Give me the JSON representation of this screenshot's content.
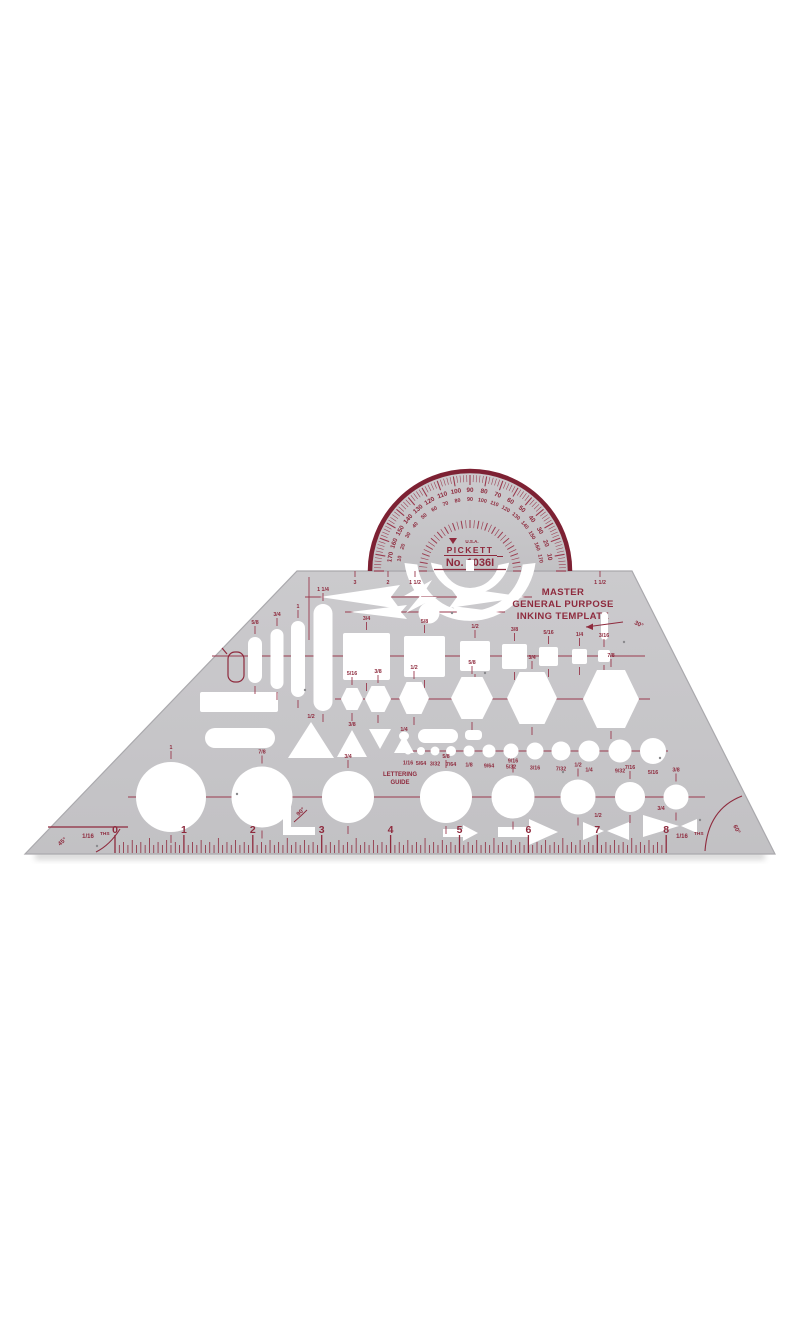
{
  "template": {
    "body_color": "#c7c6c9",
    "edge_color": "#aaa9ad",
    "print_color": "#8e2a3d",
    "tick_color": "#9a3a4e",
    "brand": "PICKETT",
    "made_in": "U.S.A.",
    "model": "No. 1036I",
    "title_lines": [
      "MASTER",
      "GENERAL PURPOSE",
      "INKING TEMPLATE"
    ],
    "lettering_guide_lines": [
      "LETTERING",
      "GUIDE"
    ]
  },
  "protractor": {
    "outer_labels": [
      "10",
      "20",
      "30",
      "40",
      "50",
      "60",
      "70",
      "80",
      "90",
      "100",
      "110",
      "120",
      "130",
      "140",
      "150",
      "160",
      "170"
    ],
    "inner_labels": [
      "170",
      "160",
      "150",
      "140",
      "130",
      "120",
      "110",
      "100",
      "90",
      "80",
      "70",
      "60",
      "50",
      "40",
      "30",
      "20",
      "10"
    ]
  },
  "ruler": {
    "numbers": [
      "0",
      "1",
      "2",
      "3",
      "4",
      "5",
      "6",
      "7",
      "8"
    ],
    "scale_fraction": "1/16",
    "scale_label": "THS"
  },
  "angle_labels": {
    "left_corner": "45°",
    "right_corner": "60°",
    "square_corner": "90°",
    "slot": "30°"
  },
  "size_labels": {
    "top_edge": [
      "3",
      "2",
      "1 1/2",
      "1 1/2"
    ],
    "bars": [
      "5/8",
      "3/4",
      "1",
      "1 1/4"
    ],
    "squares": [
      "3/4",
      "5/8",
      "1/2",
      "3/8",
      "5/16",
      "1/4",
      "3/16"
    ],
    "hexagons": [
      "5/16",
      "3/8",
      "1/2",
      "5/8",
      "3/4",
      "7/8"
    ],
    "triangles": [
      "1/2",
      "3/8",
      "1/4"
    ],
    "small_circles": [
      "1/16",
      "5/64",
      "3/32",
      "7/64",
      "1/8",
      "9/64",
      "5/32",
      "3/16",
      "7/32",
      "1/4",
      "9/32",
      "5/16"
    ],
    "large_circles": [
      "1",
      "7/8",
      "3/4",
      "5/8",
      "9/16",
      "1/2",
      "7/16",
      "3/8"
    ],
    "bowties": [
      "1/2",
      "3/4"
    ]
  }
}
